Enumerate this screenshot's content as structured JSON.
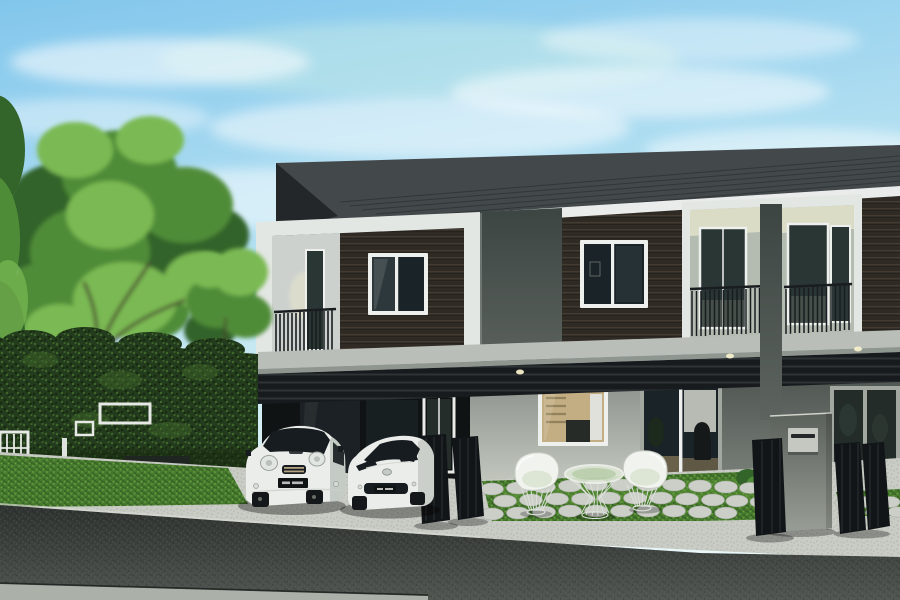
{
  "meta": {
    "title": "Modern two-storey townhouse exterior - architectural rendering",
    "scene_type": "photorealistic-render",
    "width": 900,
    "height": 600
  },
  "objects": {
    "sky": "clear blue sky with wispy clouds",
    "trees": "large green tree and small tree at left",
    "hedge": "tall green hedge wall with two white picture frames, white lattice panel, wooden bench, dark planter",
    "building": "row of modern two-storey townhouses, dark wood-slat upper facade, white border frames, dark metal roof with peak, recessed lit balconies with black railings",
    "ground_floor": "carport with glass door, kitchen window with warm interior, glass sliding doors with chair, concrete mailbox pillar, black folding gates",
    "vehicles": [
      "white compact hatchback with dark license plate",
      "white sports coupe with maker emblem"
    ],
    "garden": "two white wire armchairs and wire side table on bright lawn with round concrete stepping stones",
    "foreground": "light concrete driveway and sidewalk, dark asphalt road"
  },
  "colors": {
    "sky_top": "#82c6ec",
    "sky_mid": "#b9e3f2",
    "sky_low": "#e0f3f5",
    "sky_teal": "#cdeee7",
    "cloud": "#ffffff",
    "roof": "#43484b",
    "roof_line": "#303437",
    "roof_peak": "#24272a",
    "fascia": "#e9ecea",
    "wood": "#2f2a24",
    "wood_line": "#463d33",
    "frame_white": "#e3e7e4",
    "niche_wall": "#ccd1ce",
    "slab_top": "#3d4543",
    "slab_bottom": "#5d645f",
    "window_frame": "#eef0ee",
    "glass": "#1a2327",
    "glass_hi": "#3f4d52",
    "balc_ceiling": "#dadcc6",
    "balc_wall": "#b4bcb2",
    "balc_glass": "#2a3634",
    "railing": "#191d1f",
    "band": "#b9beb8",
    "band_shadow": "#8f958f",
    "slat": "#181b1d",
    "slat_line": "#2e3336",
    "glow": "#f4eecb",
    "carport": "#101314",
    "carport_glass": "#1d2527",
    "door_white": "#e8eae6",
    "wall_top": "#8d938d",
    "wall_bot": "#c6cbc2",
    "interior_warm": "#c3ae83",
    "interior_dark": "#262b27",
    "cabinet": "#dfe1da",
    "shelf": "#8d7c57",
    "doorframe": "#a2a8a0",
    "curtain": "#d3d6cd",
    "plant": "#1c2b1b",
    "chair_dark": "#15191a",
    "floor_warm": "#8d7c5a",
    "rwall_top": "#4e5551",
    "rwall_bot": "#7b817a",
    "rglass": "#242c29",
    "pillar_top": "#5a605a",
    "pillar_bot": "#989e95",
    "mailbox": "#c4c8c0",
    "mail_slot": "#23272a",
    "gate": "#121518",
    "gate_rib": "#2b3033",
    "concrete": "#c8ccc4",
    "conc_dot": "#b0b4ac",
    "grass": "#47792e",
    "grass_hi": "#66a23f",
    "grass_dark": "#2c511d",
    "stone": "#cbcfc7",
    "stone_edge": "#a8aca4",
    "road_top": "#2d312f",
    "road_bot": "#525651",
    "road_dot": "#5e625d",
    "curb": "#d8dcd4",
    "strip": "#abb1a9",
    "hedge": "#243c1e",
    "hedge_hi": "#3f672a",
    "hedge_dot": "#17290f",
    "leaf": "#4f8c38",
    "leaf_hi": "#7ab953",
    "leaf_dark": "#33642a",
    "trunk": "#463e2d",
    "lattice": "#e6e9e5",
    "bench_wood": "#9d8d65",
    "bench_base": "#222724",
    "planter": "#1f2521",
    "post": "#dfe3df",
    "car_white": "#ebedea",
    "car_shade": "#b4bab4",
    "car_glass": "#161c1f",
    "car_detail": "#b3a383",
    "plate": "#101314",
    "plate_mark": "#d8dad6",
    "wheel": "#14181a",
    "emblem": "#c6cac6",
    "wire": "#dce0da",
    "cushion": "#f1f3ee",
    "seat_tint": "#dde6d4"
  }
}
